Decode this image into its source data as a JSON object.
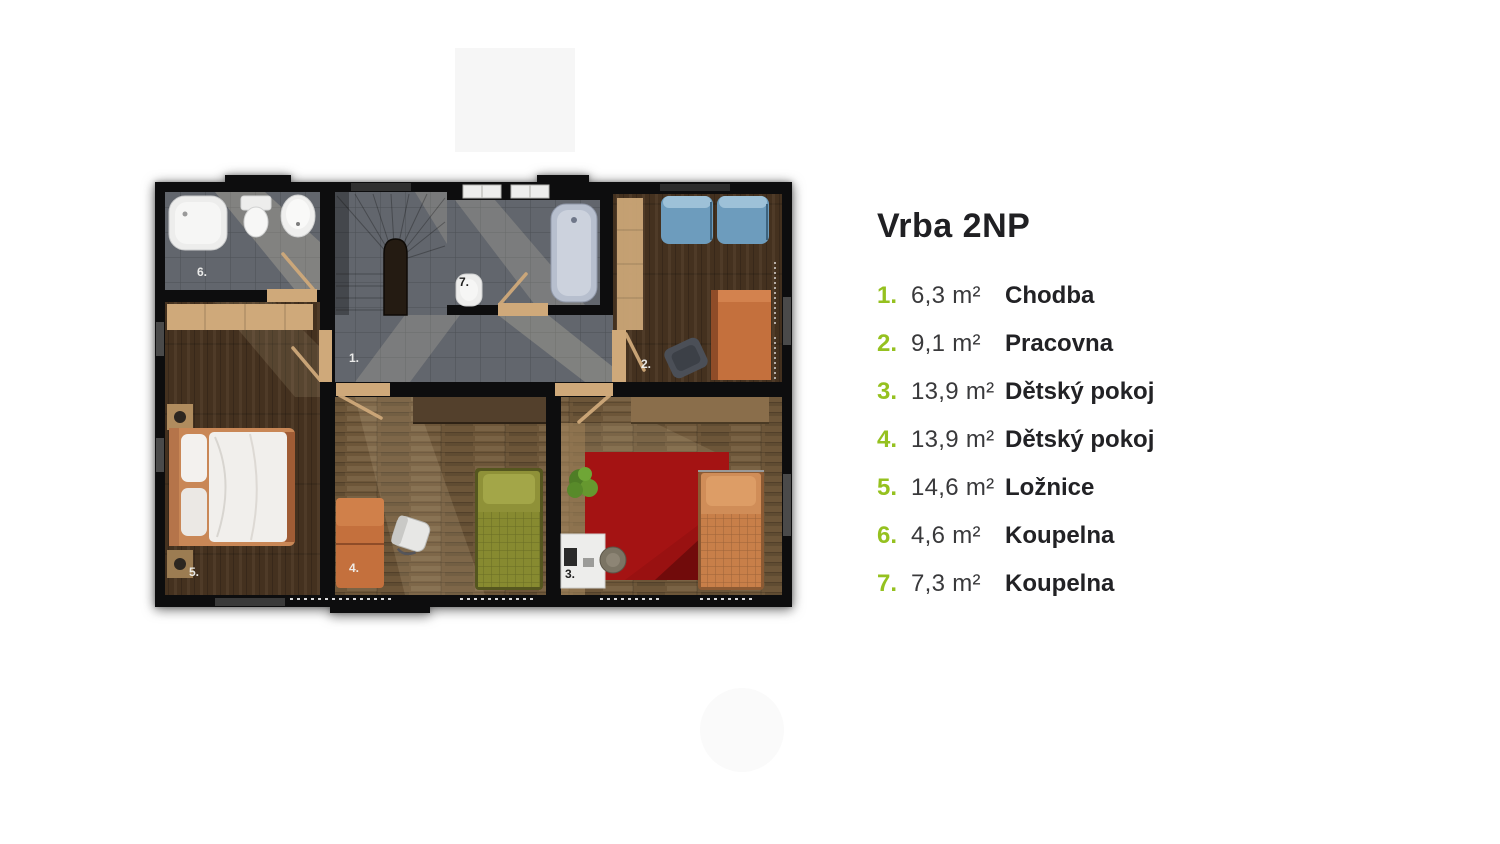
{
  "legend": {
    "title": "Vrba 2NP",
    "items": [
      {
        "num": "1.",
        "area": "6,3 m²",
        "name": "Chodba"
      },
      {
        "num": "2.",
        "area": "9,1 m²",
        "name": "Pracovna"
      },
      {
        "num": "3.",
        "area": "13,9 m²",
        "name": "Dětský pokoj"
      },
      {
        "num": "4.",
        "area": "13,9 m²",
        "name": "Dětský pokoj"
      },
      {
        "num": "5.",
        "area": "14,6 m²",
        "name": "Ložnice"
      },
      {
        "num": "6.",
        "area": "4,6 m²",
        "name": "Koupelna"
      },
      {
        "num": "7.",
        "area": "7,3 m²",
        "name": "Koupelna"
      }
    ]
  },
  "floorplan": {
    "labels": {
      "r1": "1.",
      "r2": "2.",
      "r3": "3.",
      "r4": "4.",
      "r5": "5.",
      "r6": "6.",
      "r7": "7."
    }
  },
  "colors": {
    "accent": "#95c11f",
    "wall": "#0d0d0e",
    "tile": "#62666d",
    "wood-dark": "#44311f",
    "wood-mid": "#6d5639",
    "wood-light": "#cfa97a",
    "sofa-blue": "#6d9cbd",
    "furn-orange": "#c4703d",
    "bed-olive": "#8f9138",
    "bed-orange": "#d08d58",
    "carpet-red": "#991111",
    "fixture-white": "#ededec"
  }
}
